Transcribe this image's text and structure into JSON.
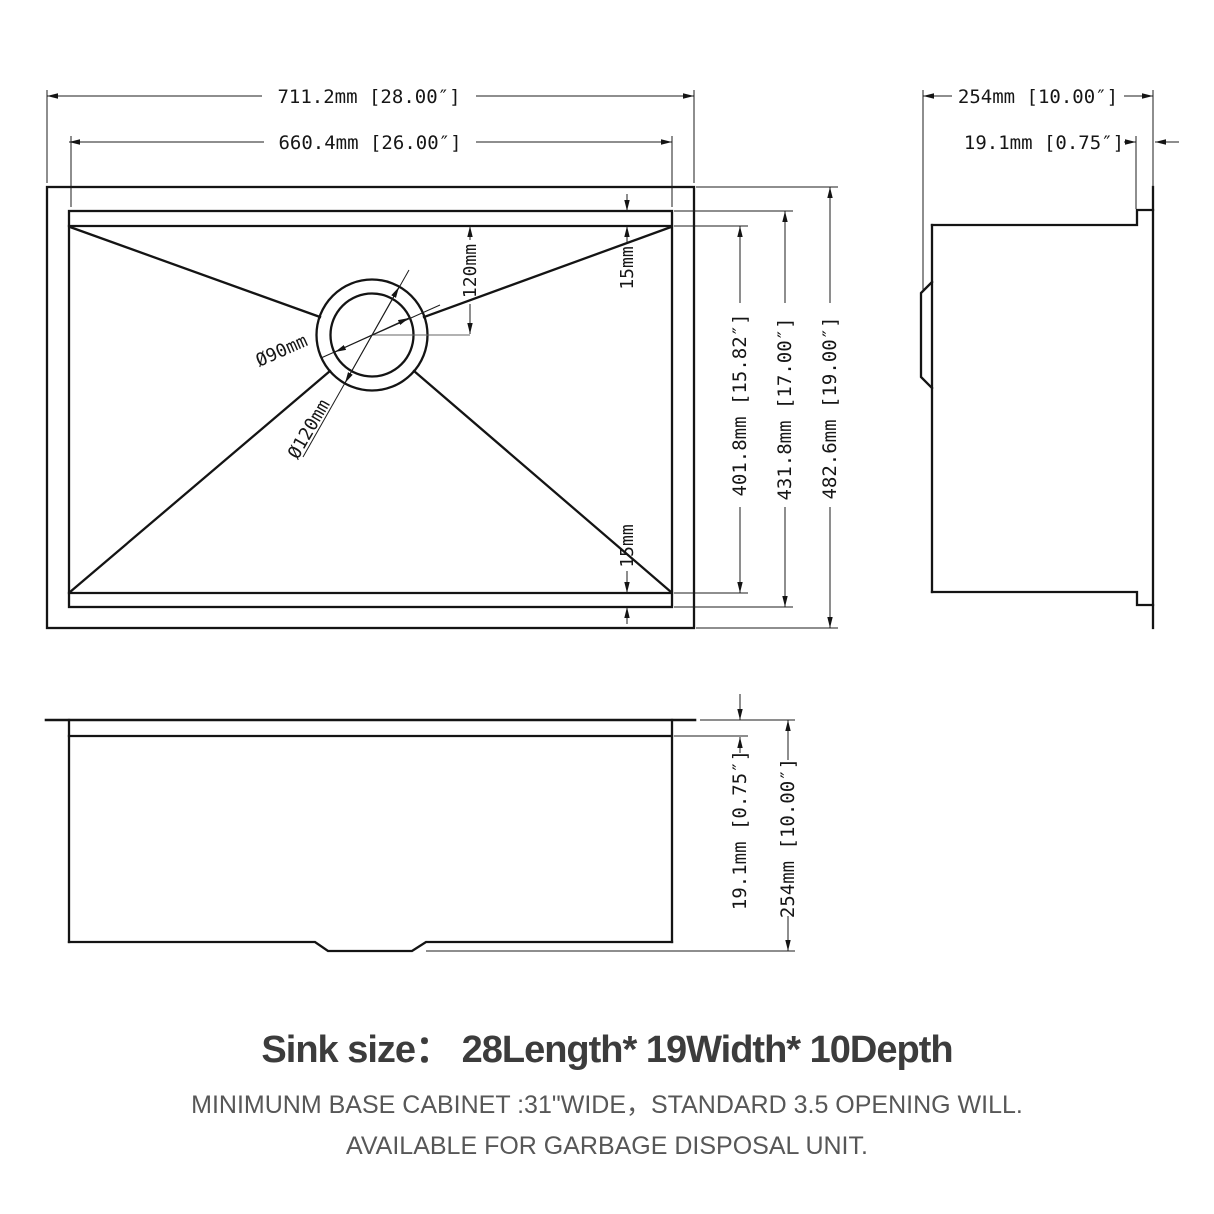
{
  "drawing": {
    "top_view": {
      "overall_width": "711.2mm [28.00″]",
      "inner_width": "660.4mm [26.00″]",
      "field_height": "401.8mm [15.82″]",
      "inner_height": "431.8mm [17.00″]",
      "overall_height": "482.6mm [19.00″]",
      "edge_offset_top": "15mm",
      "edge_offset_bottom": "15mm",
      "drain_offset": "120mm",
      "drain_inner_diameter": "Ø90mm",
      "drain_outer_diameter": "Ø120mm"
    },
    "side_view": {
      "overall_depth": "254mm [10.00″]",
      "rim_thickness": "19.1mm [0.75″]"
    },
    "front_view": {
      "rim_height": "19.1mm [0.75″]",
      "overall_depth": "254mm [10.00″]"
    }
  },
  "footer": {
    "title": "Sink size：  28Length* 19Width* 10Depth",
    "note_line1": "MINIMUNM BASE CABINET :31\"WIDE，STANDARD 3.5 OPENING WILL.",
    "note_line2": "AVAILABLE FOR GARBAGE DISPOSAL UNIT."
  },
  "palette": {
    "line_color": "#141414",
    "title_color": "#3c3c3c",
    "note_color": "#575757",
    "background": "#ffffff"
  }
}
